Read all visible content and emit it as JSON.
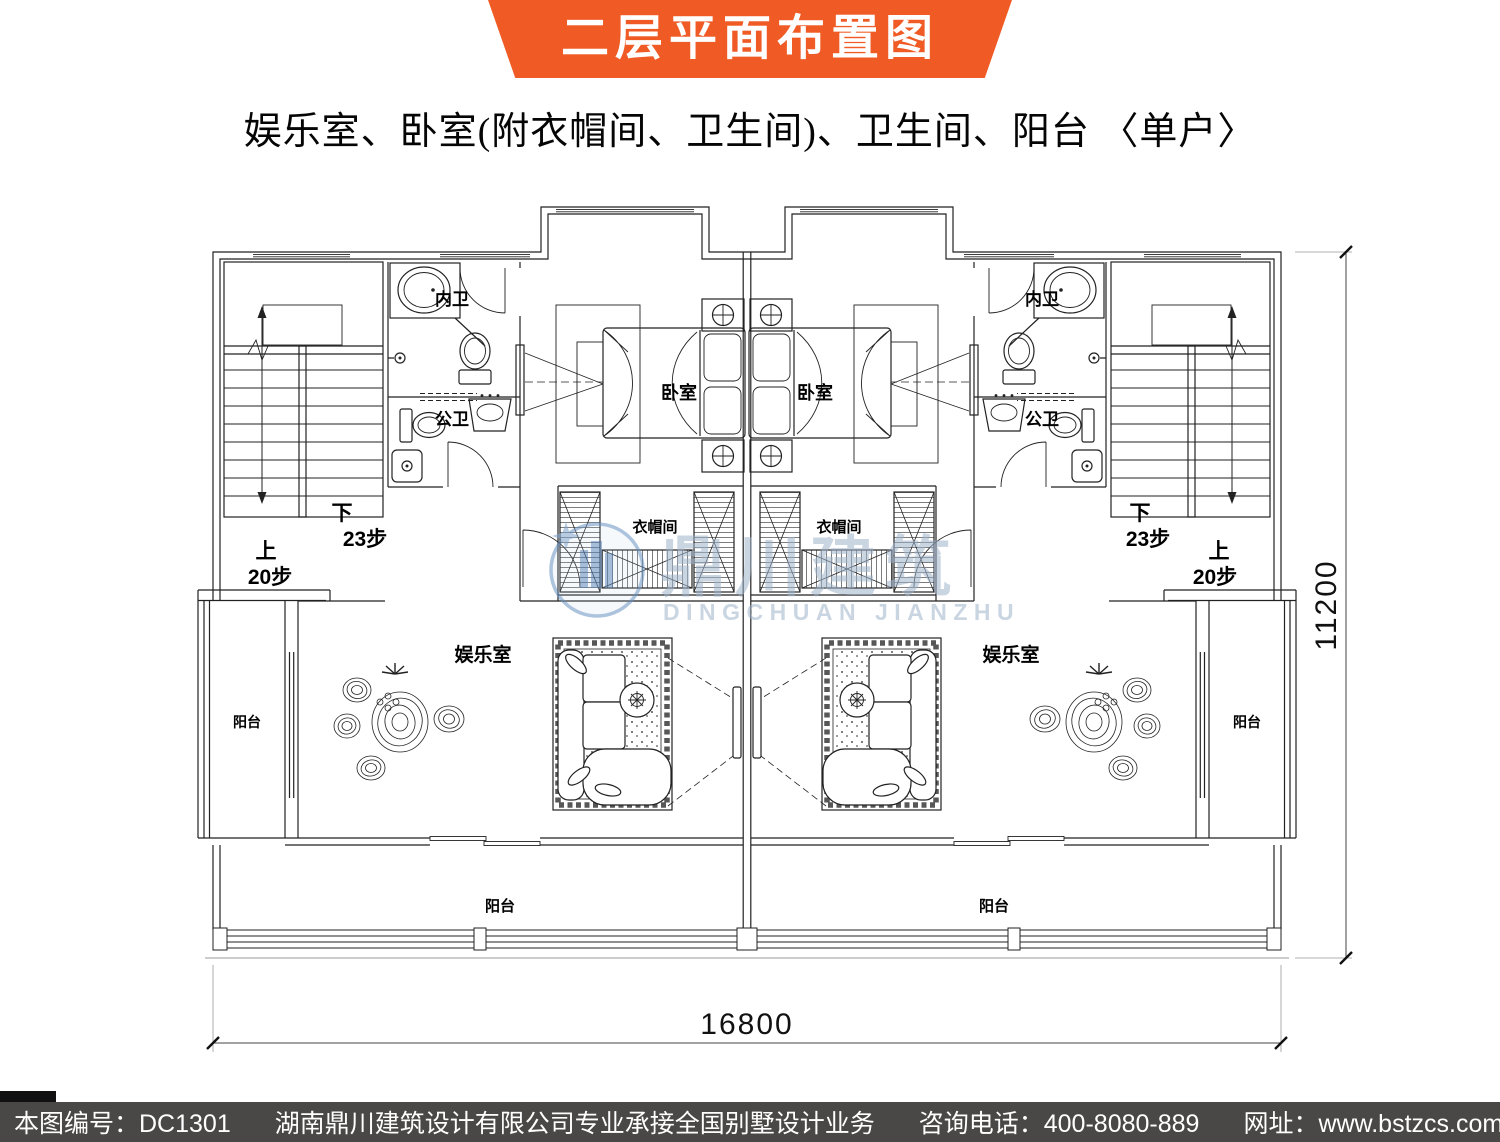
{
  "header": {
    "title": "二层平面布置图"
  },
  "subtitle": "娱乐室、卧室(附衣帽间、卫生间)、卫生间、阳台 〈单户〉",
  "plan": {
    "labels": {
      "bedroom": "卧室",
      "cloakroom": "衣帽间",
      "master_bath": "内卫",
      "shared_bath": "公卫",
      "recreation": "娱乐室",
      "balcony": "阳台",
      "stair_down": "下",
      "stair_down_steps": "23步",
      "stair_up": "上",
      "stair_up_steps": "20步"
    },
    "dimensions": {
      "width": "16800",
      "height": "11200"
    }
  },
  "watermark": {
    "name_cn": "鼎川建筑",
    "name_en": "DINGCHUAN JIANZHU"
  },
  "footer": {
    "drawing_no": "本图编号：DC1301",
    "company": "湖南鼎川建筑设计有限公司专业承接全国别墅设计业务",
    "phone": "咨询电话：400-8080-889",
    "website": "网址：www.bstzcs.com"
  },
  "colors": {
    "banner": "#f05a24",
    "footer_bg": "#4a4846",
    "watermark": "#9fb3cc",
    "line": "#222222"
  }
}
